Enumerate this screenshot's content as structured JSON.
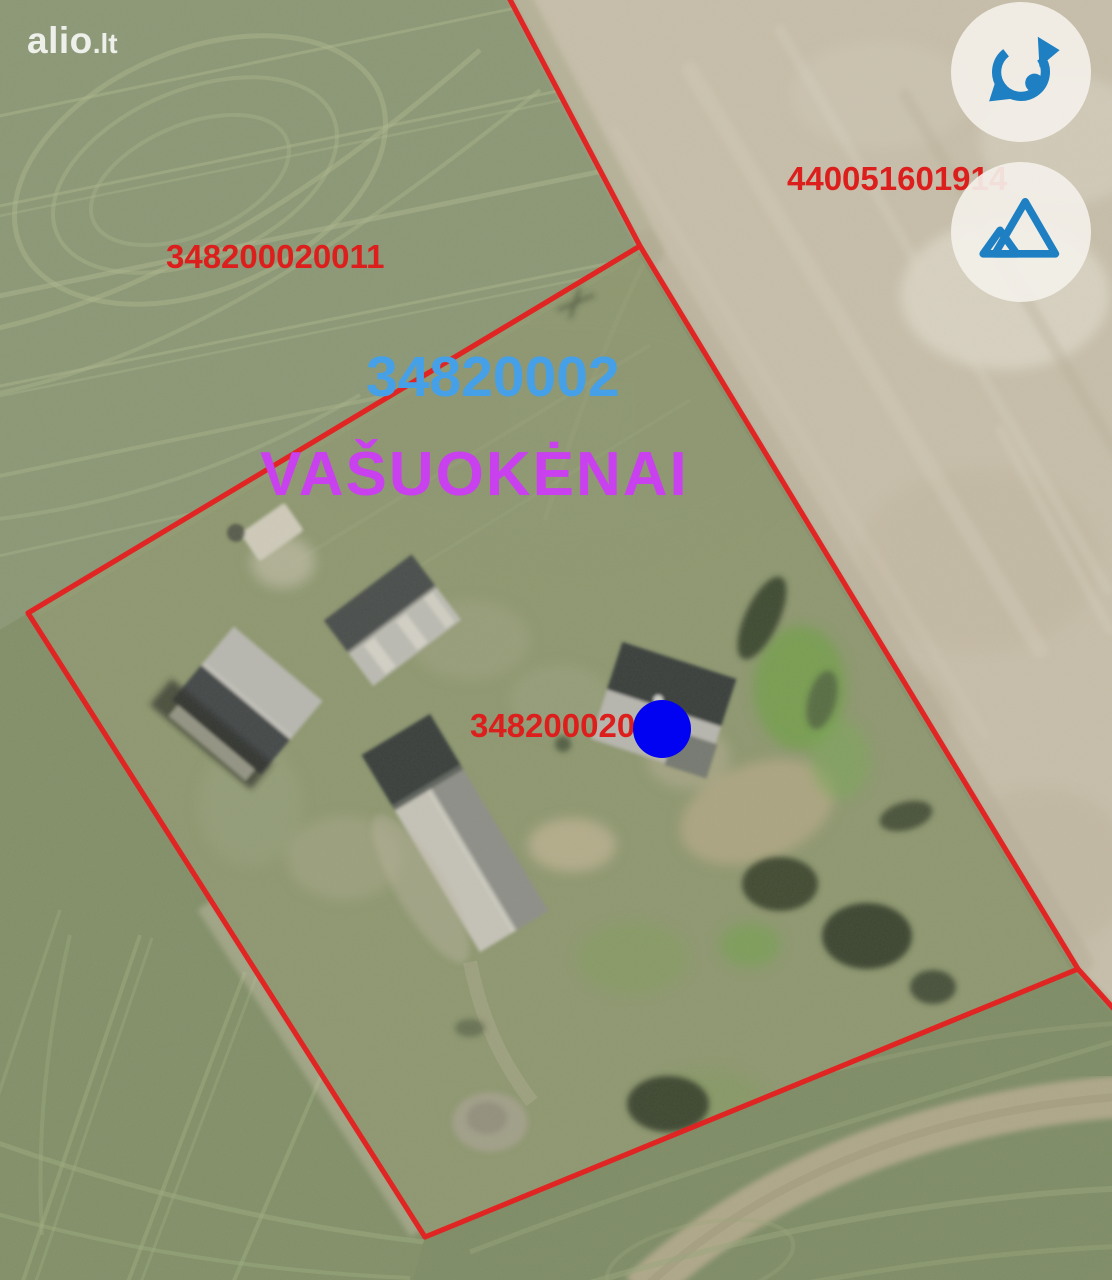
{
  "site": {
    "logo_primary": "alio",
    "logo_suffix": ".lt"
  },
  "map_labels": {
    "parcel_number_left": "348200020011",
    "parcel_number_right": "440051601914",
    "cadastral_block": "34820002",
    "settlement_name": "VAŠUOKĖNAI",
    "parcel_number_center": "348200020"
  },
  "marker": {
    "shape": "circle",
    "color": "#0202f2"
  },
  "controls": [
    {
      "id": "rotate",
      "icon": "rotate-arrow-icon"
    },
    {
      "id": "terrain",
      "icon": "mountains-icon"
    }
  ],
  "colors": {
    "boundary-red": "#e32020",
    "label-red": "#dc1f1c",
    "block-blue": "#45a0e8",
    "settlement-magenta": "#c940ee",
    "marker-blue": "#0202f2",
    "icon-blue": "#1e80c2",
    "button-bg": "rgba(243,240,233,0.92)",
    "logo-white": "rgba(252,252,250,0.88)"
  }
}
